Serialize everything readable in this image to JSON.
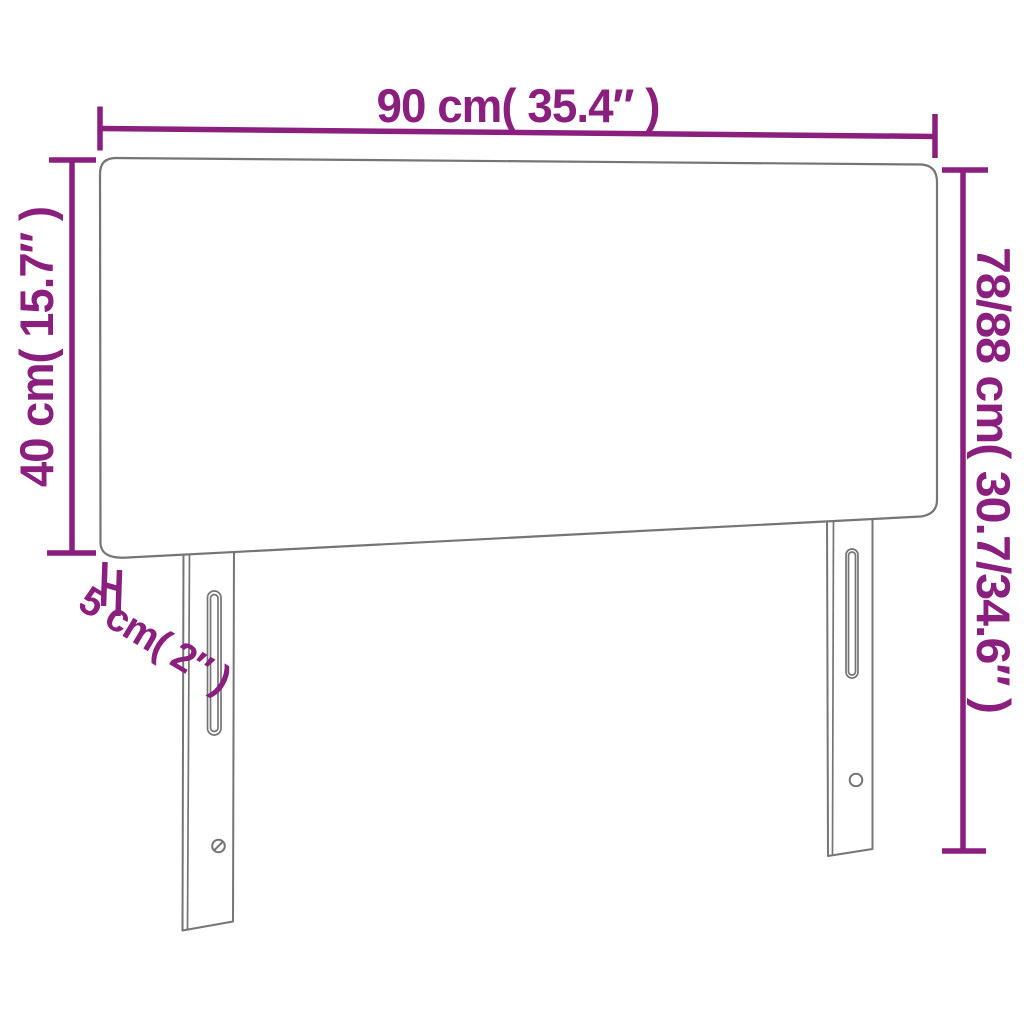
{
  "title": "Headboard dimension diagram",
  "colors": {
    "accent": "#8a1f7e",
    "outline": "#757575",
    "background": "#ffffff"
  },
  "dimensions": {
    "width": "90 cm( 35.4″ )",
    "height_left": "40 cm( 15.7″ )",
    "height_right": "78/88 cm( 30.7/34.6″ )",
    "thickness": "5 cm( 2″ )"
  }
}
